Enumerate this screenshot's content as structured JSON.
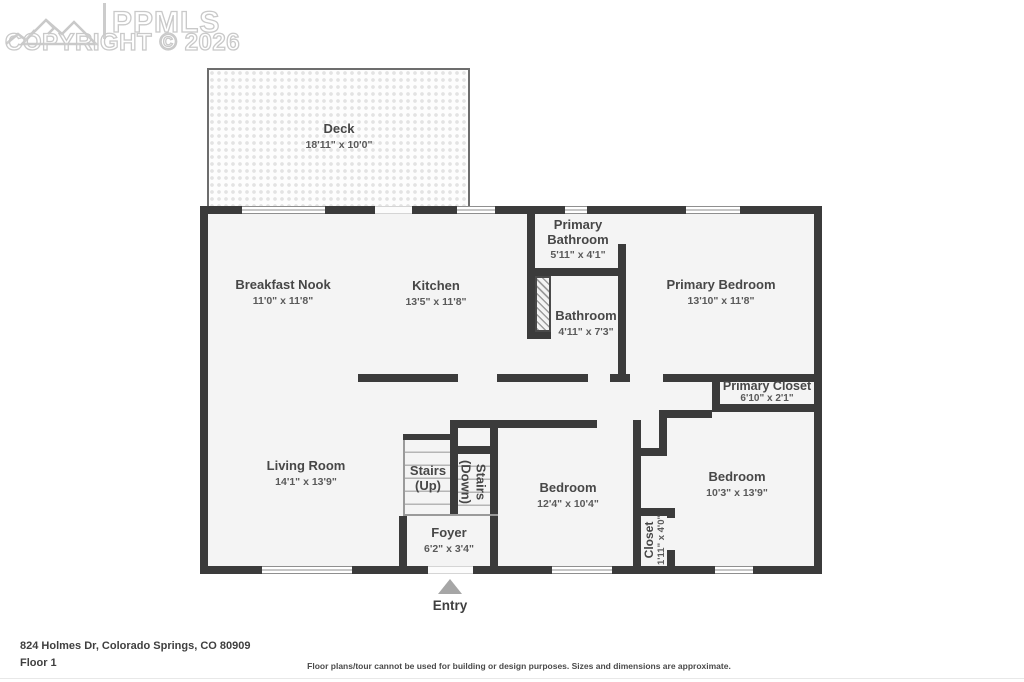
{
  "watermark": {
    "logo_text": "PPMLS",
    "copyright": "COPYRIGHT © 2026"
  },
  "rooms": [
    {
      "id": "deck",
      "name": "Deck",
      "dims": "18'11\" x 10'0\""
    },
    {
      "id": "breakfast-nook",
      "name": "Breakfast Nook",
      "dims": "11'0\" x 11'8\""
    },
    {
      "id": "kitchen",
      "name": "Kitchen",
      "dims": "13'5\" x 11'8\""
    },
    {
      "id": "primary-bathroom",
      "name": "Primary Bathroom",
      "dims": "5'11\" x 4'1\""
    },
    {
      "id": "bathroom",
      "name": "Bathroom",
      "dims": "4'11\" x 7'3\""
    },
    {
      "id": "primary-bedroom",
      "name": "Primary Bedroom",
      "dims": "13'10\" x 11'8\""
    },
    {
      "id": "primary-closet",
      "name": "Primary Closet",
      "dims": "6'10\" x 2'1\""
    },
    {
      "id": "living-room",
      "name": "Living Room",
      "dims": "14'1\" x 13'9\""
    },
    {
      "id": "stairs-up",
      "name": "Stairs (Up)",
      "dims": ""
    },
    {
      "id": "stairs-down",
      "name": "Stairs (Down)",
      "dims": ""
    },
    {
      "id": "foyer",
      "name": "Foyer",
      "dims": "6'2\" x 3'4\""
    },
    {
      "id": "bedroom-1",
      "name": "Bedroom",
      "dims": "12'4\" x 10'4\""
    },
    {
      "id": "bedroom-2",
      "name": "Bedroom",
      "dims": "10'3\" x 13'9\""
    },
    {
      "id": "closet",
      "name": "Closet",
      "dims": "1'11\" x 4'0\""
    }
  ],
  "entry_label": "Entry",
  "footer": {
    "address": "824 Holmes Dr, Colorado Springs, CO 80909",
    "floor": "Floor 1",
    "disclaimer": "Floor plans/tour cannot be used for building or design purposes. Sizes and dimensions are approximate."
  },
  "colors": {
    "wall": "#3b3b3b",
    "room_fill": "#f4f4f4",
    "label": "#474747",
    "dimension": "#5a5a5a",
    "watermark": "#c9c9c9",
    "entry_arrow": "#a6a6a6"
  }
}
